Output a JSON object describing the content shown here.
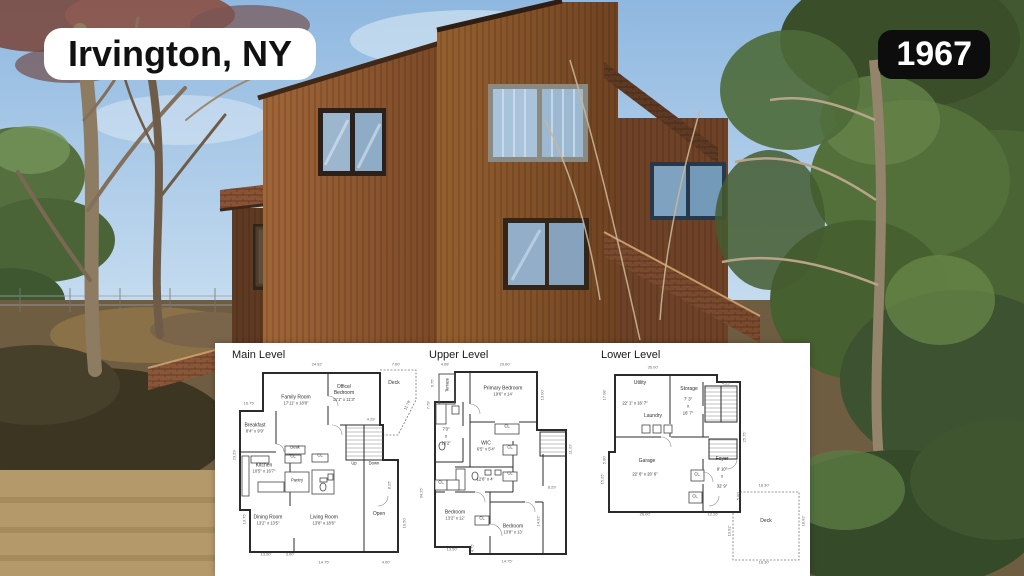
{
  "overlays": {
    "location_badge": "Irvington, NY",
    "year_badge": "1967"
  },
  "colors": {
    "badge_location_bg": "#ffffff",
    "badge_location_text": "#111111",
    "badge_year_bg": "#0d0d0d",
    "badge_year_text": "#ffffff",
    "panel_bg": "#ffffff",
    "plan_wall": "#2b2b2b",
    "sky": "#a3c4e4",
    "house_wood": "#8a5530",
    "roof_shingle": "#7b4a30",
    "foliage": "#4e6c38",
    "ground": "#6f5d42"
  },
  "floorplans": {
    "levels": [
      {
        "title": "Main Level",
        "rooms": {
          "family": {
            "name": "Family Room",
            "dims": "17'11\" x 18'8\""
          },
          "office": {
            "name": "Office/ Bedroom",
            "dims": "11'1\" x 11'3\""
          },
          "deck": {
            "name": "Deck"
          },
          "breakfast": {
            "name": "Breakfast",
            "dims": "8'4\" x 9'9\""
          },
          "kitchen": {
            "name": "Kitchen",
            "dims": "10'5\" x 16'7\""
          },
          "desk": {
            "name": "Desk"
          },
          "cl1": {
            "name": "CL"
          },
          "cl2": {
            "name": "CL"
          },
          "pantry": {
            "name": "Pantry"
          },
          "dining": {
            "name": "Dining Room",
            "dims": "13'2\" x 13'5\""
          },
          "living": {
            "name": "Living Room",
            "dims": "13'8\" x 18'6\""
          },
          "open": {
            "name": "Open"
          },
          "up": {
            "name": "Up"
          },
          "down": {
            "name": "Down"
          }
        },
        "dims": [
          "24.92'",
          "7.00'",
          "16.75'",
          "4.29'",
          "11.79'",
          "8.25'",
          "23.29'",
          "13.75'",
          "13.50'",
          "3.00'",
          "14.75'",
          "4.00'",
          "19.50'",
          "34.25'"
        ]
      },
      {
        "title": "Upper Level",
        "rooms": {
          "terrace": {
            "name": "Terrace"
          },
          "primary": {
            "name": "Primary Bedroom",
            "dims": "19'6\" x 14'"
          },
          "bath1": {
            "l1": "7'3\"",
            "l2": "x",
            "l3": "16'2\""
          },
          "wic": {
            "name": "WIC",
            "dims": "6'5\" x 5'4\""
          },
          "bath2": {
            "dims": "12'6\" x 4'"
          },
          "cl_a": {
            "name": "CL"
          },
          "cl_b": {
            "name": "CL"
          },
          "cl_c": {
            "name": "CL"
          },
          "cl_d": {
            "name": "CL"
          },
          "cl_e": {
            "name": "CL"
          },
          "bedroom1": {
            "name": "Bedroom",
            "dims": "13'2\" x 12'"
          },
          "bedroom2": {
            "name": "Bedroom",
            "dims": "13'8\" x 13'"
          }
        },
        "dims": [
          "4.08'",
          "20.60'",
          "6.75'",
          "7.79'",
          "13.00'",
          "8.29'",
          "11.22'",
          "14.92'",
          "13.50'",
          "4.75'",
          "14.75'"
        ]
      },
      {
        "title": "Lower Level",
        "rooms": {
          "utility": {
            "name": "Utility",
            "dims": "22' 1\" x 16' 7\""
          },
          "storage": {
            "name": "Storage",
            "l1": "7' 3\"",
            "l2": "x",
            "l3": "16' 7\""
          },
          "laundry": {
            "name": "Laundry"
          },
          "garage": {
            "name": "Garage",
            "dims": "22' 6\" x 20' 6\""
          },
          "foyer": {
            "name": "Foyer",
            "l1": "9' 10\"",
            "l2": "x",
            "l3": "32' 9\""
          },
          "cl1": {
            "name": "CL"
          },
          "cl2": {
            "name": "CL"
          },
          "deck": {
            "name": "Deck"
          }
        },
        "dims": [
          "35.00'",
          "4.25'",
          "17.08'",
          "5.00'",
          "15.25'",
          "26.00'",
          "12.26'",
          "25.75'",
          "18.30'",
          "13.92'",
          "18.92'",
          "18.30'",
          "5.00'"
        ]
      }
    ]
  }
}
